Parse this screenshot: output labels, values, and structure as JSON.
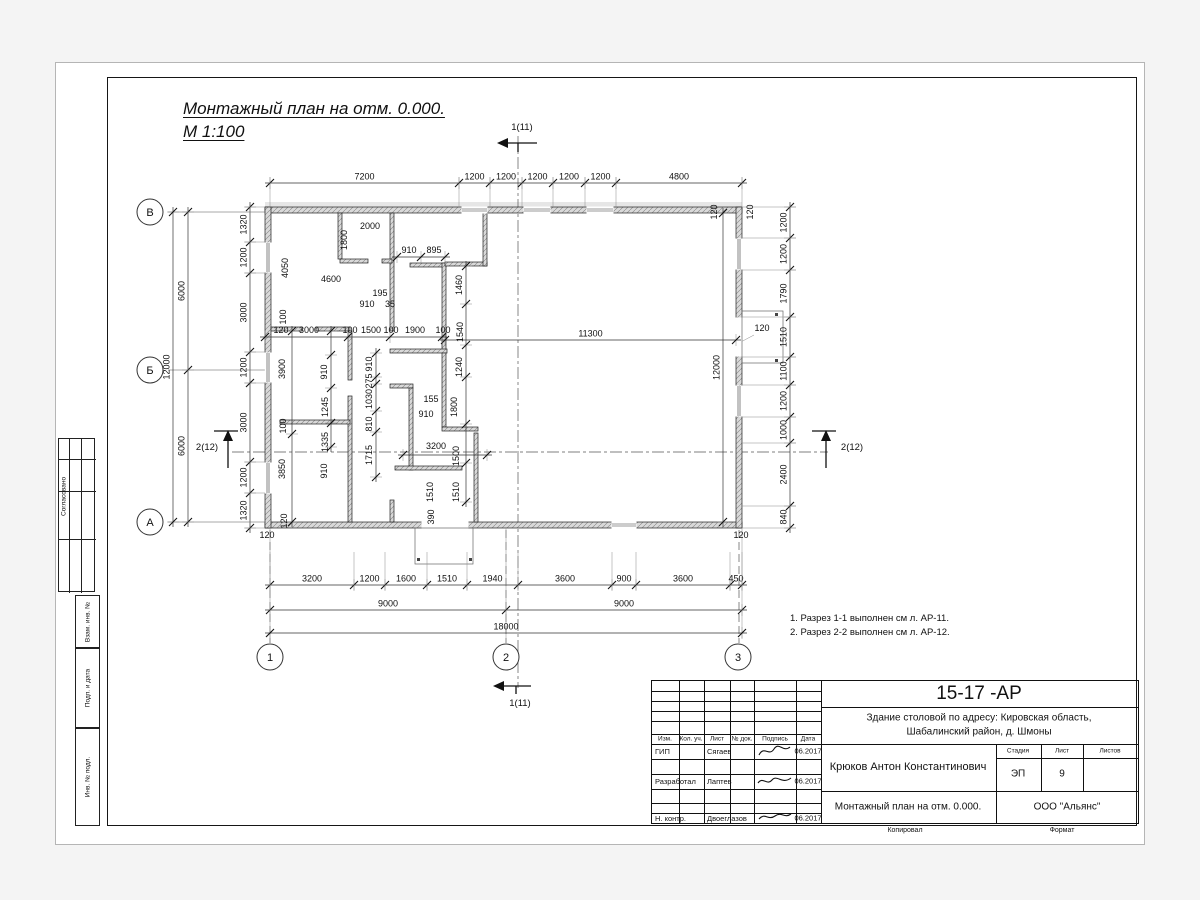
{
  "sheet": {
    "title_line1": "Монтажный план на отм. 0.000.",
    "title_line2": "М 1:100"
  },
  "notes": [
    "1. Разрез 1-1 выполнен см л. АР-11.",
    "2. Разрез 2-2 выполнен см л. АР-12."
  ],
  "side_panel": {
    "approve": "Согласовано",
    "strips": [
      "Взам. инв. №",
      "Подп. и дата",
      "Инв. № подл."
    ]
  },
  "title_block": {
    "doc_number": "15-17 -АР",
    "object_line1": "Здание столовой по адресу: Кировская область,",
    "object_line2": "Шабалинский район, д. Шмоны",
    "chief": "Крюков Антон Константинович",
    "sheet_name": "Монтажный план на отм. 0.000.",
    "company": "ООО \"Альянс\"",
    "cols": [
      "Изм.",
      "Кол. уч.",
      "Лист",
      "№ док.",
      "Подпись",
      "Дата"
    ],
    "rows": [
      {
        "role": "ГИП",
        "name": "Сягаев",
        "date": "06.2017"
      },
      {
        "role": "Разработал",
        "name": "Лаптев",
        "date": "06.2017"
      },
      {
        "role": "Н. контр.",
        "name": "Двоеглазов",
        "date": "06.2017"
      }
    ],
    "stage_label": "Стадия",
    "sheet_label": "Лист",
    "sheets_label": "Листов",
    "stage": "ЭП",
    "sheet_no": "9",
    "sheets": "",
    "copied_label": "Копировал",
    "format_label": "Формат"
  },
  "plan": {
    "axes_rows": [
      {
        "label": "В",
        "x": 150,
        "y": 212
      },
      {
        "label": "Б",
        "x": 150,
        "y": 370
      },
      {
        "label": "А",
        "x": 150,
        "y": 522
      }
    ],
    "axes_cols": [
      {
        "label": "1",
        "x": 270,
        "y": 657
      },
      {
        "label": "2",
        "x": 506,
        "y": 657
      },
      {
        "label": "3",
        "x": 738,
        "y": 657
      }
    ],
    "section_marks": [
      {
        "t": "1(11)",
        "x": 522,
        "y": 130
      },
      {
        "t": "1(11)",
        "x": 520,
        "y": 706
      },
      {
        "t": "2(12)",
        "x": 207,
        "y": 450
      },
      {
        "t": "2(12)",
        "x": 852,
        "y": 450
      }
    ],
    "chains": [
      {
        "o": "h",
        "pos": 183,
        "ticks": [
          270,
          459,
          490,
          522,
          553,
          585,
          616,
          742
        ],
        "labels": [
          "7200",
          "1200",
          "1200",
          "1200",
          "1200",
          "1200",
          "4800"
        ],
        "ext": [
          177,
          207
        ]
      },
      {
        "o": "v",
        "pos": 250,
        "ticks": [
          207,
          242,
          273,
          352,
          383,
          462,
          493,
          528
        ],
        "labels": [
          "1320",
          "1200",
          "3000",
          "1200",
          "3000",
          "1200",
          "1320"
        ],
        "ext": [
          245,
          265
        ]
      },
      {
        "o": "v",
        "pos": 188,
        "ticks": [
          212,
          370,
          522
        ],
        "labels": [
          "6000",
          "6000"
        ],
        "ext": [
          168,
          265
        ]
      },
      {
        "o": "v",
        "pos": 173,
        "ticks": [
          212,
          522
        ],
        "labels": [
          "12000"
        ]
      },
      {
        "o": "v",
        "pos": 790,
        "ticks": [
          207,
          238,
          270,
          317,
          357,
          385,
          417,
          443,
          506,
          528
        ],
        "labels": [
          "1200",
          "1200",
          "1790",
          "1510",
          "1100",
          "1200",
          "1000",
          "2400",
          "840"
        ],
        "ext": [
          742,
          796
        ]
      },
      {
        "o": "h",
        "pos": 585,
        "ticks": [
          270,
          354,
          385,
          427,
          467,
          518,
          612,
          636,
          730,
          742
        ],
        "labels": [
          "3200",
          "1200",
          "1600",
          "1510",
          "1940",
          "3600",
          "900",
          "3600",
          "450"
        ],
        "ext": [
          552,
          590
        ]
      },
      {
        "o": "h",
        "pos": 610,
        "ticks": [
          270,
          506,
          742
        ],
        "labels": [
          "9000",
          "9000"
        ],
        "ext": [
          528,
          638
        ]
      },
      {
        "o": "h",
        "pos": 633,
        "ticks": [
          270,
          742
        ],
        "labels": [
          "18000"
        ]
      },
      {
        "o": "h",
        "pos": 340,
        "ticks": [
          445,
          736
        ],
        "labels": [
          "11300"
        ]
      },
      {
        "o": "v",
        "pos": 723,
        "ticks": [
          213,
          522
        ],
        "labels": [
          "12000"
        ]
      },
      {
        "o": "h",
        "pos": 337,
        "ticks": [
          265,
          348,
          390,
          442
        ],
        "labels": []
      },
      {
        "o": "v",
        "pos": 292,
        "ticks": [
          331,
          434,
          522
        ],
        "labels": []
      },
      {
        "o": "v",
        "pos": 331,
        "ticks": [
          331,
          355,
          388,
          423,
          447
        ],
        "labels": []
      },
      {
        "o": "v",
        "pos": 376,
        "ticks": [
          353,
          377,
          384,
          411,
          432,
          477
        ],
        "labels": []
      },
      {
        "o": "v",
        "pos": 466,
        "ticks": [
          266,
          304,
          345,
          377,
          424,
          463,
          502
        ],
        "labels": []
      },
      {
        "o": "h",
        "pos": 455,
        "ticks": [
          403,
          487
        ],
        "labels": []
      },
      {
        "o": "h",
        "pos": 257,
        "ticks": [
          397,
          421,
          445
        ],
        "labels": []
      }
    ],
    "texts": [
      {
        "t": "2000",
        "x": 370,
        "y": 229
      },
      {
        "t": "1800",
        "x": 347,
        "y": 240,
        "r": 1
      },
      {
        "t": "4050",
        "x": 288,
        "y": 268,
        "r": 1
      },
      {
        "t": "4600",
        "x": 331,
        "y": 282
      },
      {
        "t": "910",
        "x": 409,
        "y": 253
      },
      {
        "t": "895",
        "x": 434,
        "y": 253
      },
      {
        "t": "195",
        "x": 380,
        "y": 296
      },
      {
        "t": "910",
        "x": 367,
        "y": 307
      },
      {
        "t": "35",
        "x": 390,
        "y": 307
      },
      {
        "t": "1460",
        "x": 462,
        "y": 285,
        "r": 1
      },
      {
        "t": "1540",
        "x": 463,
        "y": 332,
        "r": 1
      },
      {
        "t": "100",
        "x": 286,
        "y": 317,
        "r": 1
      },
      {
        "t": "120",
        "x": 281,
        "y": 333
      },
      {
        "t": "3000",
        "x": 309,
        "y": 333
      },
      {
        "t": "100",
        "x": 350,
        "y": 333
      },
      {
        "t": "1500",
        "x": 371,
        "y": 333
      },
      {
        "t": "100",
        "x": 391,
        "y": 333
      },
      {
        "t": "1900",
        "x": 415,
        "y": 333
      },
      {
        "t": "100",
        "x": 443,
        "y": 333
      },
      {
        "t": "3900",
        "x": 285,
        "y": 369,
        "r": 1
      },
      {
        "t": "910",
        "x": 327,
        "y": 372,
        "r": 1
      },
      {
        "t": "910",
        "x": 372,
        "y": 364,
        "r": 1
      },
      {
        "t": "275",
        "x": 372,
        "y": 381,
        "r": 1
      },
      {
        "t": "1030",
        "x": 372,
        "y": 399,
        "r": 1
      },
      {
        "t": "1240",
        "x": 462,
        "y": 367,
        "r": 1
      },
      {
        "t": "1245",
        "x": 328,
        "y": 407,
        "r": 1
      },
      {
        "t": "810",
        "x": 372,
        "y": 424,
        "r": 1
      },
      {
        "t": "100",
        "x": 286,
        "y": 426,
        "r": 1
      },
      {
        "t": "155",
        "x": 431,
        "y": 402
      },
      {
        "t": "910",
        "x": 426,
        "y": 417
      },
      {
        "t": "1800",
        "x": 457,
        "y": 407,
        "r": 1
      },
      {
        "t": "1335",
        "x": 328,
        "y": 442,
        "r": 1
      },
      {
        "t": "1715",
        "x": 372,
        "y": 455,
        "r": 1
      },
      {
        "t": "3200",
        "x": 436,
        "y": 449
      },
      {
        "t": "1500",
        "x": 459,
        "y": 456,
        "r": 1
      },
      {
        "t": "3850",
        "x": 285,
        "y": 469,
        "r": 1
      },
      {
        "t": "910",
        "x": 327,
        "y": 471,
        "r": 1
      },
      {
        "t": "1510",
        "x": 433,
        "y": 492,
        "r": 1
      },
      {
        "t": "1510",
        "x": 459,
        "y": 492,
        "r": 1
      },
      {
        "t": "390",
        "x": 434,
        "y": 517,
        "r": 1
      },
      {
        "t": "120",
        "x": 287,
        "y": 521,
        "r": 1
      },
      {
        "t": "120",
        "x": 267,
        "y": 538
      },
      {
        "t": "120",
        "x": 741,
        "y": 538
      },
      {
        "t": "120",
        "x": 762,
        "y": 331
      },
      {
        "t": "120",
        "x": 753,
        "y": 212,
        "r": 1
      },
      {
        "t": "120",
        "x": 717,
        "y": 212,
        "r": 1
      }
    ]
  }
}
